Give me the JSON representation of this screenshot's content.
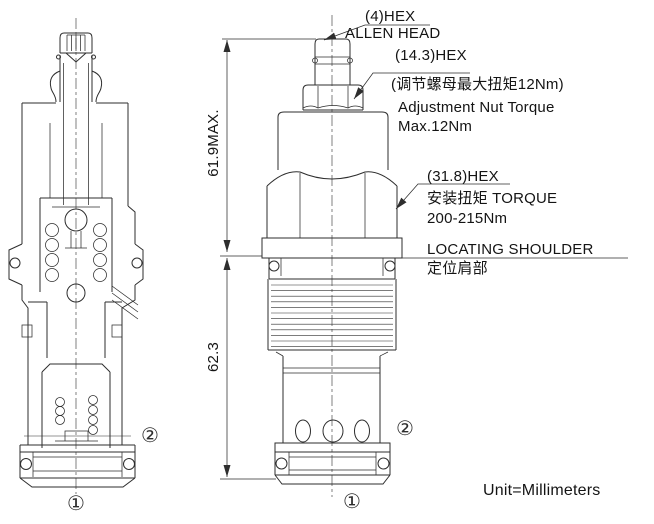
{
  "drawing": {
    "unit_note": "Unit=Millimeters",
    "dimensions": {
      "upper_height": "61.9MAX.",
      "lower_height": "62.3"
    },
    "callouts": {
      "allen_head": {
        "line1": "(4)HEX",
        "line2": "ALLEN HEAD"
      },
      "adjustment_nut": {
        "line1": "(14.3)HEX",
        "line2": "(调节螺母最大扭矩12Nm)",
        "line3": "Adjustment Nut Torque",
        "line4": "Max.12Nm"
      },
      "install_hex": {
        "line1": "(31.8)HEX",
        "line2": "安装扭矩 TORQUE",
        "line3": "200-215Nm"
      },
      "locating_shoulder": {
        "line1": "LOCATING SHOULDER",
        "line2": "定位肩部"
      }
    },
    "ports": {
      "port1": "①",
      "port2": "②"
    },
    "colors": {
      "line": "#2e2e2e",
      "text": "#141414",
      "background": "#ffffff"
    }
  }
}
